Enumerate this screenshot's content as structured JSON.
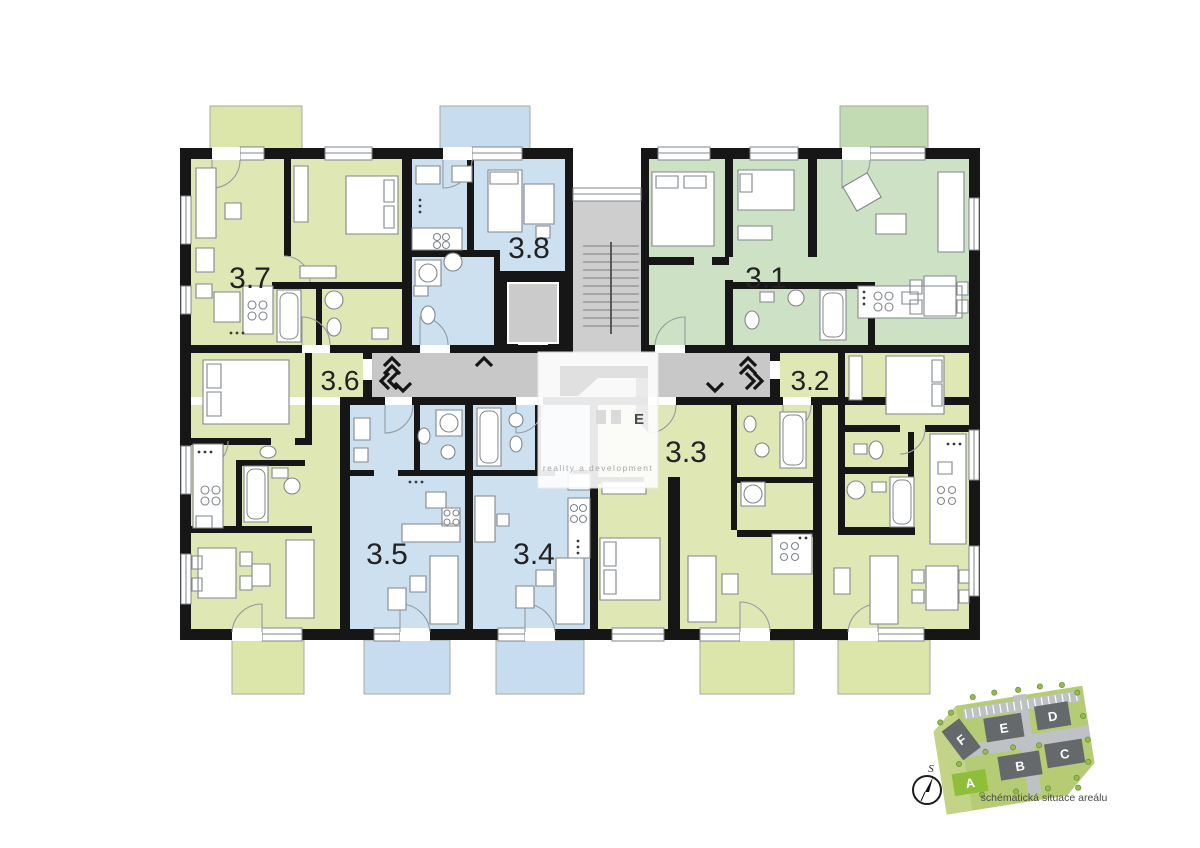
{
  "units": [
    {
      "label": "3.7",
      "color_key": "olive"
    },
    {
      "label": "3.8",
      "color_key": "blue"
    },
    {
      "label": "3.1",
      "color_key": "green"
    },
    {
      "label": "3.6",
      "color_key": "olive"
    },
    {
      "label": "3.2",
      "color_key": "olive"
    },
    {
      "label": "3.3",
      "color_key": "olive"
    },
    {
      "label": "3.5",
      "color_key": "blue"
    },
    {
      "label": "3.4",
      "color_key": "blue"
    }
  ],
  "colors": {
    "olive": "#dfe7b5",
    "green": "#cde2c4",
    "blue": "#cde0f0",
    "balcony_olive": "#dce6ab",
    "balcony_blue": "#c7ddef",
    "balcony_green": "#c2dbb2",
    "wall": "#161616",
    "corridor": "#c8c8c8",
    "stair": "#cecece",
    "elevator_cab": "#cbcbcb",
    "site_land": "#b5cc74",
    "site_land_light": "#c3d488",
    "site_road": "#bfc2c4",
    "site_building": "#65696c",
    "site_highlight": "#8fbe3a",
    "site_tree": "#96b955"
  },
  "watermark": {
    "logo_text": "E",
    "tagline": "reality a development"
  },
  "site_map": {
    "caption": "schématická situace areálu",
    "compass_label": "S",
    "highlighted": "A",
    "buildings": [
      {
        "label": "F"
      },
      {
        "label": "E"
      },
      {
        "label": "D"
      },
      {
        "label": "A"
      },
      {
        "label": "B"
      },
      {
        "label": "C"
      }
    ]
  }
}
